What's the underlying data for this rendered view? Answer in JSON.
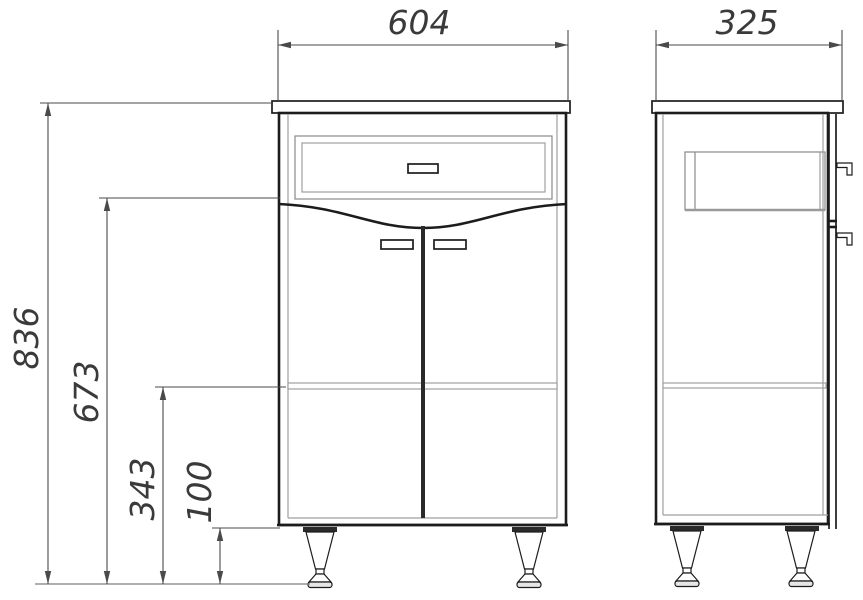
{
  "drawing": {
    "kind": "cabinet-dimension-drawing",
    "dimensions": {
      "width": "604",
      "depth": "325",
      "total_height": "836",
      "doors_top_height": "673",
      "shelf_height": "343",
      "legs_height": "100"
    },
    "colors": {
      "outline": "#1c1c1c",
      "dimension_line": "#4a4a4a",
      "light_line": "#9f9f9f",
      "text": "#3a3a3a",
      "background": "#ffffff"
    }
  }
}
